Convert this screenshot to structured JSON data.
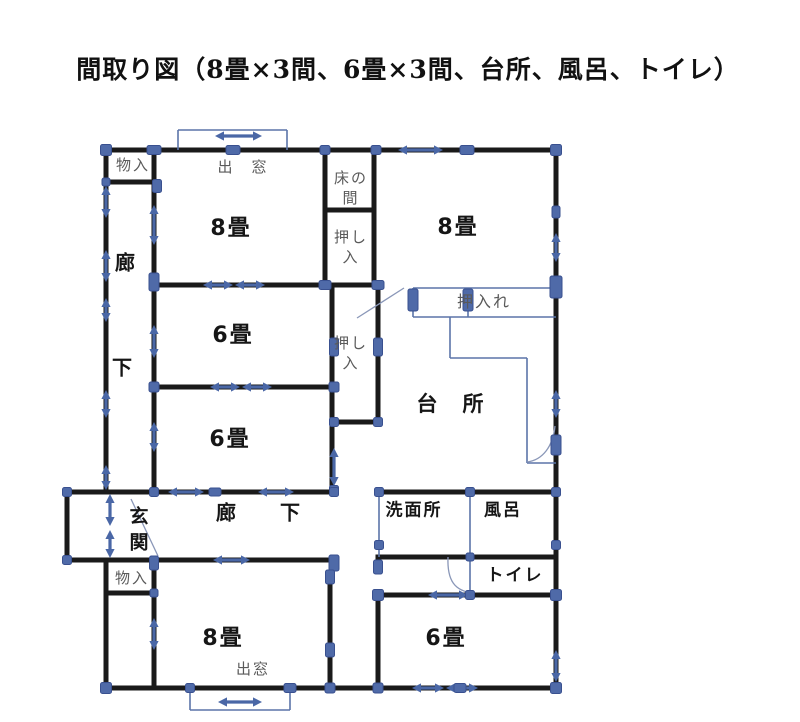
{
  "title": "間取り図（8畳×3間、6畳×3間、台所、風呂、トイレ）",
  "colors": {
    "wall": "#1a1a1a",
    "thin_blue": "#5b74a8",
    "leaf": "#8a97b8",
    "marker_fill": "#4f6aa8",
    "marker_edge": "#39508f",
    "arrow": "#4a67a6",
    "label_dark": "#161616",
    "label_grey": "#5a5a5a"
  },
  "labels": [
    {
      "id": "monoire-top",
      "text": "物入",
      "x": 133,
      "y": 165,
      "size": 15,
      "color": "grey",
      "bold": false
    },
    {
      "id": "demado-top",
      "text": "出　窓",
      "x": 243,
      "y": 167,
      "size": 15,
      "color": "grey",
      "bold": false
    },
    {
      "id": "tokonoma",
      "text": "床の\n間",
      "x": 351,
      "y": 188,
      "size": 15,
      "color": "grey",
      "bold": false
    },
    {
      "id": "oshiire-1",
      "text": "押し\n入",
      "x": 351,
      "y": 247,
      "size": 15,
      "color": "grey",
      "bold": false
    },
    {
      "id": "room-8jo-top-left",
      "text": "8畳",
      "x": 231,
      "y": 229,
      "size": 22,
      "color": "dark",
      "bold": true
    },
    {
      "id": "rouka-v-1",
      "text": "廊",
      "x": 126,
      "y": 263,
      "size": 20,
      "color": "dark",
      "bold": true
    },
    {
      "id": "rouka-v-2",
      "text": "下",
      "x": 123,
      "y": 368,
      "size": 20,
      "color": "dark",
      "bold": true
    },
    {
      "id": "room-6jo-mid",
      "text": "6畳",
      "x": 233,
      "y": 336,
      "size": 22,
      "color": "dark",
      "bold": true
    },
    {
      "id": "oshiire-2",
      "text": "押し\n入",
      "x": 351,
      "y": 353,
      "size": 15,
      "color": "grey",
      "bold": false
    },
    {
      "id": "room-6jo-lower",
      "text": "6畳",
      "x": 230,
      "y": 440,
      "size": 22,
      "color": "dark",
      "bold": true
    },
    {
      "id": "room-8jo-top-right",
      "text": "8畳",
      "x": 458,
      "y": 228,
      "size": 22,
      "color": "dark",
      "bold": true
    },
    {
      "id": "oshiire-kitchen",
      "text": "押入れ",
      "x": 484,
      "y": 302,
      "size": 16,
      "color": "grey",
      "bold": false
    },
    {
      "id": "daidokoro",
      "text": "台　所",
      "x": 451,
      "y": 404,
      "size": 21,
      "color": "dark",
      "bold": true
    },
    {
      "id": "genkan",
      "text": "玄\n関",
      "x": 140,
      "y": 530,
      "size": 19,
      "color": "dark",
      "bold": true
    },
    {
      "id": "rouka-h-1",
      "text": "廊",
      "x": 227,
      "y": 513,
      "size": 20,
      "color": "dark",
      "bold": true
    },
    {
      "id": "rouka-h-2",
      "text": "下",
      "x": 291,
      "y": 513,
      "size": 20,
      "color": "dark",
      "bold": true
    },
    {
      "id": "monoire-bottom",
      "text": "物入",
      "x": 132,
      "y": 578,
      "size": 15,
      "color": "grey",
      "bold": false
    },
    {
      "id": "senmenjo",
      "text": "洗面所",
      "x": 414,
      "y": 511,
      "size": 17,
      "color": "dark",
      "bold": true
    },
    {
      "id": "furo",
      "text": "風呂",
      "x": 503,
      "y": 511,
      "size": 17,
      "color": "dark",
      "bold": true
    },
    {
      "id": "toire",
      "text": "トイレ",
      "x": 515,
      "y": 576,
      "size": 17,
      "color": "dark",
      "bold": true
    },
    {
      "id": "room-8jo-bottom",
      "text": "8畳",
      "x": 223,
      "y": 639,
      "size": 22,
      "color": "dark",
      "bold": true
    },
    {
      "id": "demado-bottom",
      "text": "出窓",
      "x": 253,
      "y": 669,
      "size": 15,
      "color": "grey",
      "bold": false
    },
    {
      "id": "room-6jo-bottom",
      "text": "6畳",
      "x": 446,
      "y": 639,
      "size": 22,
      "color": "dark",
      "bold": true
    }
  ],
  "plan": {
    "walls": [
      [
        106,
        150,
        556,
        150
      ],
      [
        106,
        182,
        157,
        182
      ],
      [
        325,
        210,
        374,
        210
      ],
      [
        154,
        285,
        378,
        285
      ],
      [
        154,
        387,
        334,
        387
      ],
      [
        332,
        422,
        378,
        422
      ],
      [
        67,
        492,
        334,
        492
      ],
      [
        67,
        560,
        334,
        560
      ],
      [
        106,
        593,
        154,
        593
      ],
      [
        378,
        492,
        556,
        492
      ],
      [
        378,
        557,
        556,
        557
      ],
      [
        378,
        595,
        556,
        595
      ],
      [
        106,
        688,
        556,
        688
      ],
      [
        106,
        150,
        106,
        492
      ],
      [
        106,
        560,
        106,
        688
      ],
      [
        154,
        150,
        154,
        492
      ],
      [
        154,
        560,
        154,
        688
      ],
      [
        325,
        150,
        325,
        285
      ],
      [
        332,
        285,
        332,
        422
      ],
      [
        332,
        422,
        332,
        492
      ],
      [
        374,
        150,
        374,
        285
      ],
      [
        378,
        285,
        378,
        422
      ],
      [
        556,
        150,
        556,
        688
      ],
      [
        67,
        492,
        67,
        560
      ],
      [
        330,
        585,
        330,
        688
      ],
      [
        378,
        595,
        378,
        688
      ]
    ],
    "thin_lines": [
      [
        178,
        130,
        287,
        130
      ],
      [
        178,
        130,
        178,
        150
      ],
      [
        287,
        130,
        287,
        150
      ],
      [
        190,
        688,
        190,
        710
      ],
      [
        190,
        710,
        290,
        710
      ],
      [
        290,
        688,
        290,
        710
      ],
      [
        413,
        288,
        556,
        288
      ],
      [
        413,
        288,
        413,
        317
      ],
      [
        413,
        317,
        556,
        317
      ],
      [
        468,
        288,
        468,
        317
      ],
      [
        450,
        317,
        450,
        358
      ],
      [
        450,
        358,
        527,
        358
      ],
      [
        527,
        358,
        527,
        463
      ],
      [
        527,
        463,
        556,
        463
      ],
      [
        379,
        492,
        379,
        557
      ],
      [
        470,
        492,
        470,
        557
      ],
      [
        470,
        557,
        470,
        595
      ]
    ],
    "leaf_lines": [
      [
        131,
        499,
        158,
        556
      ],
      [
        357,
        318,
        404,
        288
      ]
    ],
    "arcs": [
      "M 448 557 C 447 581 455 591 473 593",
      "M 527 462 C 543 460 553 446 555 426"
    ],
    "markers": [
      [
        106,
        150,
        11,
        11
      ],
      [
        154,
        150,
        14,
        9
      ],
      [
        233,
        150,
        14,
        9
      ],
      [
        325,
        150,
        10,
        9
      ],
      [
        376,
        150,
        10,
        9
      ],
      [
        467,
        150,
        14,
        9
      ],
      [
        556,
        150,
        11,
        11
      ],
      [
        106,
        182,
        8,
        8
      ],
      [
        157,
        186,
        9,
        13
      ],
      [
        154,
        282,
        10,
        18
      ],
      [
        325,
        285,
        12,
        9
      ],
      [
        378,
        285,
        12,
        9
      ],
      [
        556,
        212,
        8,
        12
      ],
      [
        556,
        287,
        12,
        22
      ],
      [
        413,
        300,
        10,
        22
      ],
      [
        468,
        300,
        10,
        22
      ],
      [
        154,
        387,
        10,
        10
      ],
      [
        334,
        387,
        10,
        10
      ],
      [
        334,
        347,
        9,
        18
      ],
      [
        378,
        347,
        9,
        18
      ],
      [
        334,
        422,
        9,
        9
      ],
      [
        378,
        422,
        9,
        9
      ],
      [
        334,
        490,
        9,
        9
      ],
      [
        556,
        445,
        10,
        20
      ],
      [
        67,
        492,
        9,
        9
      ],
      [
        154,
        492,
        9,
        9
      ],
      [
        215,
        492,
        12,
        8
      ],
      [
        334,
        492,
        9,
        9
      ],
      [
        379,
        492,
        9,
        9
      ],
      [
        470,
        492,
        9,
        9
      ],
      [
        556,
        492,
        9,
        9
      ],
      [
        379,
        545,
        9,
        9
      ],
      [
        556,
        545,
        9,
        9
      ],
      [
        67,
        560,
        9,
        9
      ],
      [
        154,
        563,
        9,
        14
      ],
      [
        334,
        563,
        10,
        16
      ],
      [
        378,
        567,
        9,
        14
      ],
      [
        154,
        593,
        8,
        8
      ],
      [
        470,
        557,
        8,
        8
      ],
      [
        378,
        595,
        11,
        11
      ],
      [
        470,
        595,
        9,
        9
      ],
      [
        556,
        595,
        11,
        11
      ],
      [
        330,
        577,
        9,
        14
      ],
      [
        330,
        650,
        9,
        14
      ],
      [
        106,
        688,
        11,
        11
      ],
      [
        190,
        688,
        9,
        9
      ],
      [
        290,
        688,
        12,
        9
      ],
      [
        330,
        688,
        10,
        10
      ],
      [
        378,
        688,
        10,
        10
      ],
      [
        460,
        688,
        12,
        9
      ],
      [
        556,
        688,
        11,
        11
      ]
    ],
    "arrows": [
      [
        215,
        136,
        262,
        136
      ],
      [
        398,
        150,
        443,
        150
      ],
      [
        203,
        285,
        233,
        285
      ],
      [
        235,
        285,
        265,
        285
      ],
      [
        210,
        387,
        240,
        387
      ],
      [
        242,
        387,
        272,
        387
      ],
      [
        168,
        492,
        204,
        492
      ],
      [
        258,
        492,
        294,
        492
      ],
      [
        213,
        560,
        250,
        560
      ],
      [
        428,
        595,
        468,
        595
      ],
      [
        412,
        688,
        444,
        688
      ],
      [
        446,
        688,
        478,
        688
      ],
      [
        218,
        702,
        262,
        702
      ],
      [
        106,
        186,
        106,
        218
      ],
      [
        106,
        250,
        106,
        282
      ],
      [
        106,
        298,
        106,
        322
      ],
      [
        106,
        390,
        106,
        418
      ],
      [
        106,
        465,
        106,
        490
      ],
      [
        154,
        205,
        154,
        245
      ],
      [
        154,
        325,
        154,
        358
      ],
      [
        154,
        422,
        154,
        452
      ],
      [
        154,
        618,
        154,
        650
      ],
      [
        110,
        494,
        110,
        526
      ],
      [
        110,
        530,
        110,
        558
      ],
      [
        334,
        448,
        334,
        486
      ],
      [
        556,
        233,
        556,
        262
      ],
      [
        556,
        390,
        556,
        418
      ],
      [
        556,
        650,
        556,
        682
      ]
    ]
  }
}
